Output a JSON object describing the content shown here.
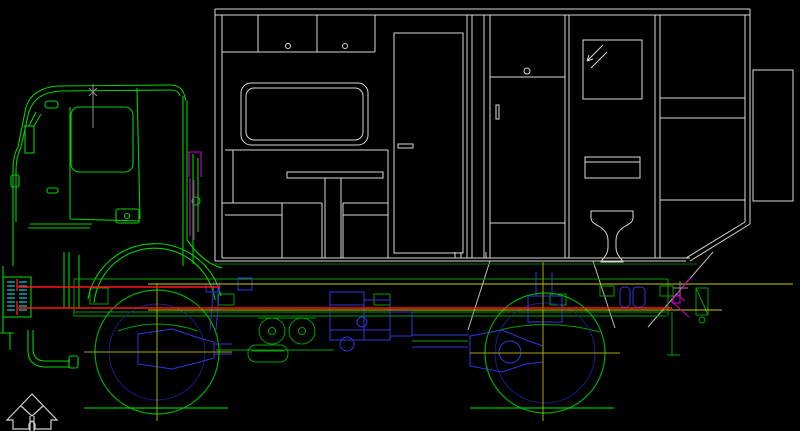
{
  "meta": {
    "title": "Expedition truck with box camper - CAD wireframe side elevation",
    "drawing_type": "CAD line drawing",
    "canvas": {
      "width": 800,
      "height": 431
    }
  },
  "palette": {
    "background": "#000000",
    "body_white": "#d9d9d9",
    "strut_white": "#c0c0c0",
    "cab_green": "#00d200",
    "chassis_green": "#00a000",
    "ground_green": "#00c000",
    "floor_dark_green": "#007000",
    "tire_green": "#00aa00",
    "drivetrain_blue": "#3434de",
    "rim_blue": "#1e1e96",
    "datum_red": "#ff1414",
    "datum_yellow": "#caca00",
    "centerline_yellow": "#a8a800",
    "grille_cyan": "#00c8c8",
    "detail_magenta": "#cc00cc",
    "marker_gray": "#909090",
    "arrow_gray": "#d0d0d0"
  },
  "components": {
    "cab": "truck-cab",
    "box": "camper-box-body",
    "door": "entry-door",
    "window": "lounge-window",
    "cabinets": "overhead-cabinets",
    "dinette": "dinette-table-and-benches",
    "wardrobe": "wardrobe-cabinet",
    "mirror": "bathroom-mirror",
    "toilet": "toilet",
    "rear_compartment": "rear-storage-compartment",
    "front_wheel": "front-wheel",
    "rear_wheel": "rear-wheel",
    "drivetrain": "engine-gearbox-axles",
    "grille": "front-grille",
    "arrow": "orientation-arrow"
  }
}
